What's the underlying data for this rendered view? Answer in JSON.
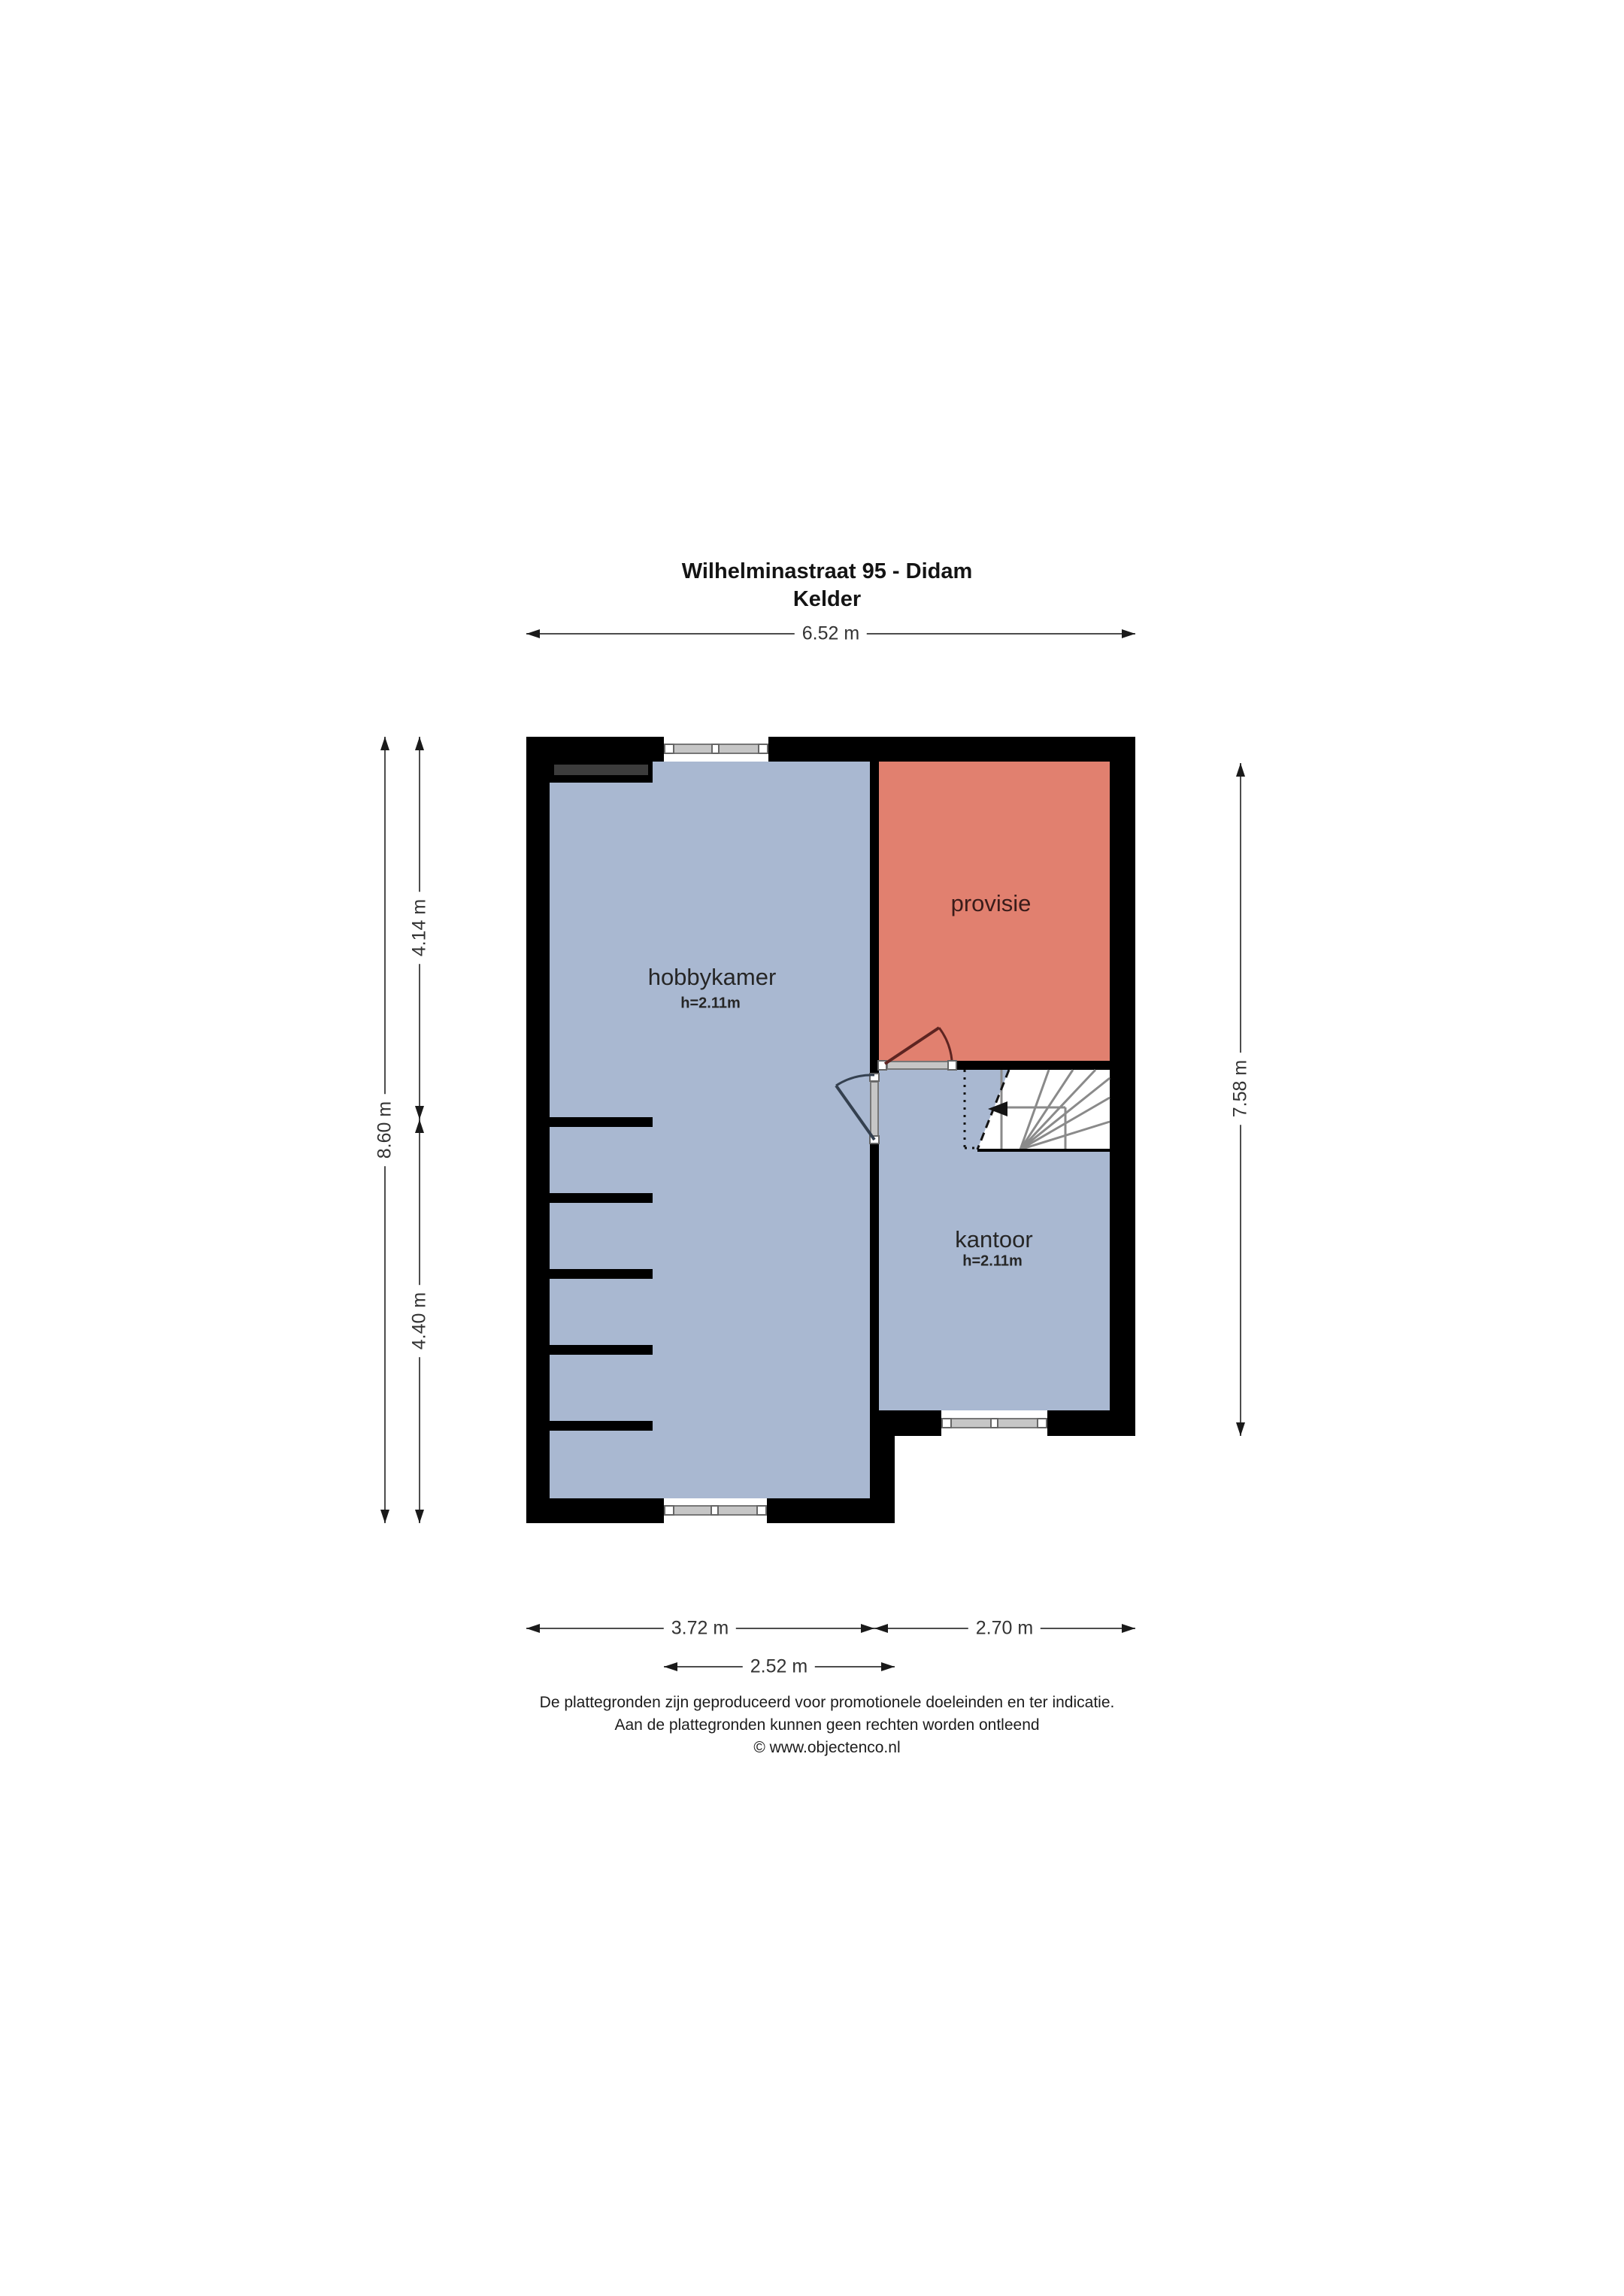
{
  "title": {
    "line1": "Wilhelminastraat 95 - Didam",
    "line2": "Kelder"
  },
  "rooms": {
    "hobbykamer": {
      "name": "hobbykamer",
      "ceiling": "h=2.11m"
    },
    "provisie": {
      "name": "provisie"
    },
    "kantoor": {
      "name": "kantoor",
      "ceiling": "h=2.11m"
    }
  },
  "dimensions": {
    "top_width": "6.52 m",
    "left_total": "8.60 m",
    "left_upper": "4.14 m",
    "left_lower": "4.40 m",
    "right_height": "7.58 m",
    "bottom_left": "3.72 m",
    "bottom_right": "2.70 m",
    "bottom_inner": "2.52 m"
  },
  "footer": {
    "line1": "De plattegronden zijn geproduceerd voor promotionele doeleinden en ter indicatie.",
    "line2": "Aan de plattegronden kunnen geen rechten worden ontleend",
    "line3": "© www.objectenco.nl"
  },
  "colors": {
    "room_fill_blue": "#a9b8d1",
    "room_fill_red": "#e1806f",
    "wall": "#000000",
    "cabinet_gray": "#3c3c3c",
    "window_sill_gray": "#c6c6c6",
    "dimension_line": "#4d4d4d"
  }
}
